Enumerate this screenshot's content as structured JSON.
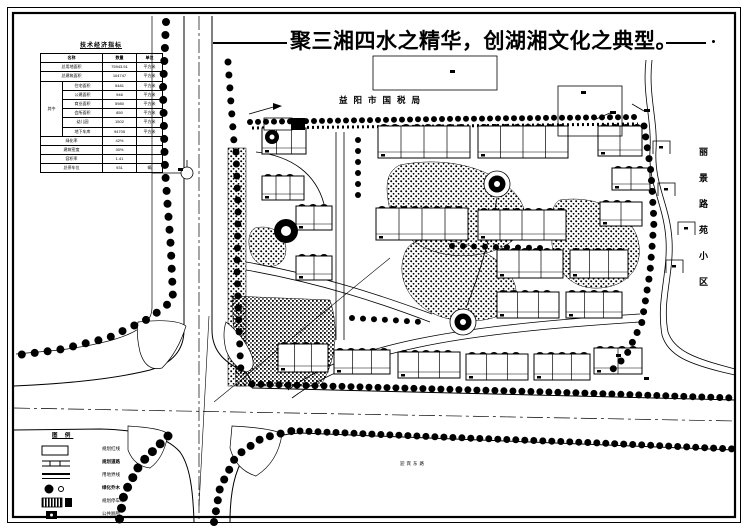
{
  "page": {
    "slogan": "聚三湘四水之精华，创湖湘文化之典型。"
  },
  "indicator_table": {
    "title": "技术经济指标",
    "headers": [
      "名称",
      "数量",
      "单位"
    ],
    "group_label": "其中",
    "rows_top": [
      {
        "name": "总用地面积",
        "value": "75943.51",
        "unit": "平方米"
      },
      {
        "name": "总建筑面积",
        "value": "104747",
        "unit": "平方米"
      }
    ],
    "rows_group": [
      {
        "name": "住宅面积",
        "value": "5481",
        "unit": "平方米"
      },
      {
        "name": "公建面积",
        "value": "946",
        "unit": "平方米"
      },
      {
        "name": "商业面积",
        "value": "5980",
        "unit": "平方米"
      },
      {
        "name": "会所面积",
        "value": "850",
        "unit": "平方米"
      },
      {
        "name": "幼儿园",
        "value": "1502",
        "unit": "平方米"
      },
      {
        "name": "地下车库",
        "value": "94705",
        "unit": "平方米"
      }
    ],
    "rows_bottom": [
      {
        "name": "绿化率",
        "value": "42%",
        "unit": ""
      },
      {
        "name": "建筑密度",
        "value": "30%",
        "unit": ""
      },
      {
        "name": "容积率",
        "value": "1.41",
        "unit": ""
      },
      {
        "name": "总停车位",
        "value": "931",
        "unit": "辆"
      }
    ]
  },
  "map_labels": {
    "north_parcel": "益阳市国税局",
    "east_district": "丽景路苑小区",
    "south_road": "迎宾东路"
  },
  "legend": {
    "title": "图 例",
    "items": [
      {
        "symbol": "red-line-boundary",
        "label": "规划红线"
      },
      {
        "symbol": "planned-road",
        "label": "规划道路"
      },
      {
        "symbol": "land-boundary",
        "label": "用地界线"
      },
      {
        "symbol": "trees",
        "label": "绿化乔木"
      },
      {
        "symbol": "parking",
        "label": "规划停车坪"
      },
      {
        "symbol": "public-toilet",
        "label": "公共厕所"
      }
    ]
  }
}
